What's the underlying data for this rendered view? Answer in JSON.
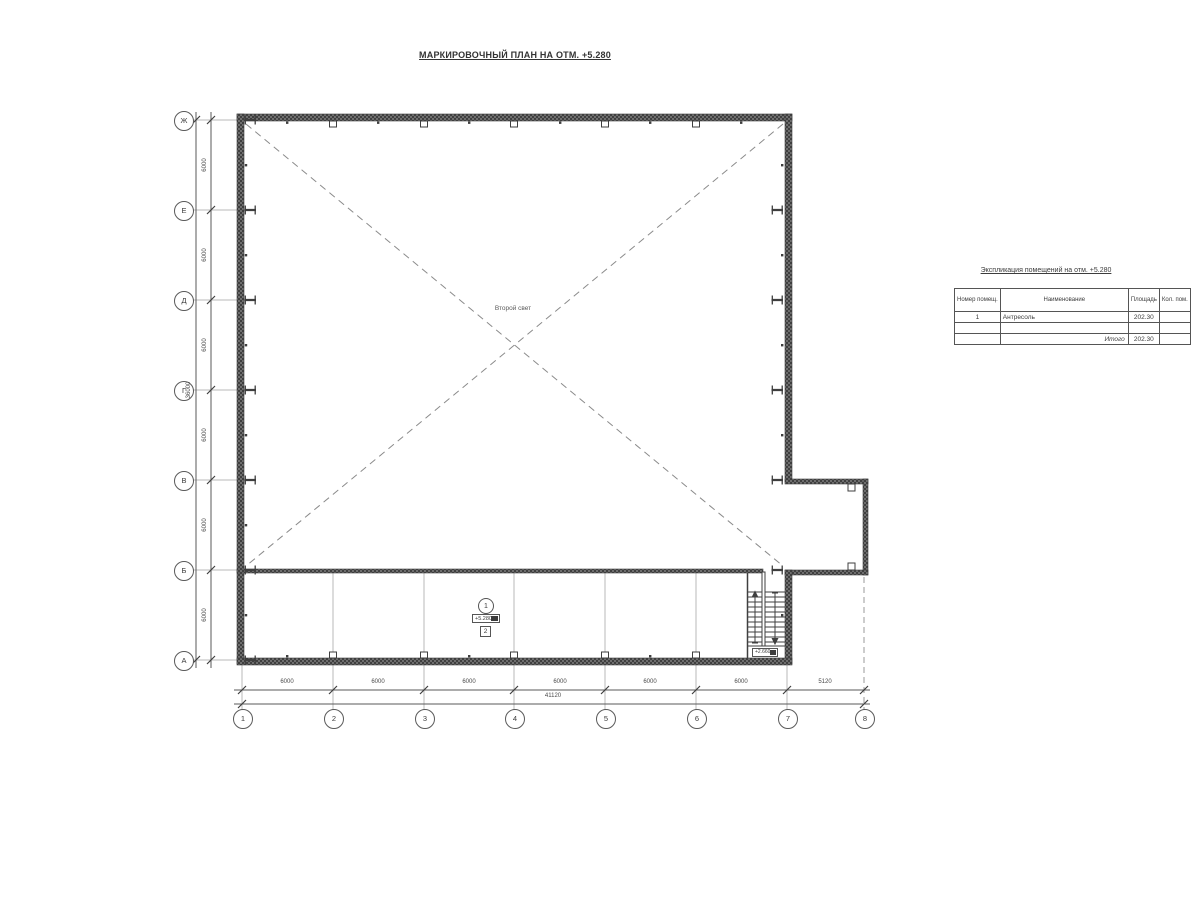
{
  "drawing": {
    "title": "МАРКИРОВОЧНЫЙ ПЛАН НА ОТМ. +5.280",
    "annotations": {
      "second_light": "Второй свет",
      "room_number": "1",
      "room_elevation": "+5.280",
      "room_type_mark": "2",
      "stair_elevation": "+2.660"
    },
    "axes": {
      "rows": [
        "Ж",
        "Е",
        "Д",
        "Г",
        "В",
        "Б",
        "А"
      ],
      "cols": [
        "1",
        "2",
        "3",
        "4",
        "5",
        "6",
        "7",
        "8"
      ]
    },
    "dimensions": {
      "left_bays": [
        "6000",
        "6000",
        "6000",
        "6000",
        "6000",
        "6000"
      ],
      "left_total": "36000",
      "bottom_bays": [
        "6000",
        "6000",
        "6000",
        "6000",
        "6000",
        "6000",
        "5120"
      ],
      "bottom_total": "41120"
    }
  },
  "table": {
    "title": "Экспликация помещений на отм. +5.280",
    "headers": [
      "Номер помещ.",
      "Наименование",
      "Площадь",
      "Кол. пом."
    ],
    "rows": [
      {
        "num": "1",
        "name": "Антресоль",
        "area": "202.30",
        "count": ""
      },
      {
        "num": "",
        "name": "",
        "area": "",
        "count": ""
      },
      {
        "num": "",
        "name": "Итого",
        "area": "202.30",
        "count": ""
      }
    ]
  },
  "colors": {
    "wall_dark": "#4a4a4a",
    "line_medium": "#5a5a5a",
    "line_light": "#b8b8b8",
    "dash": "#8a8a8a"
  }
}
